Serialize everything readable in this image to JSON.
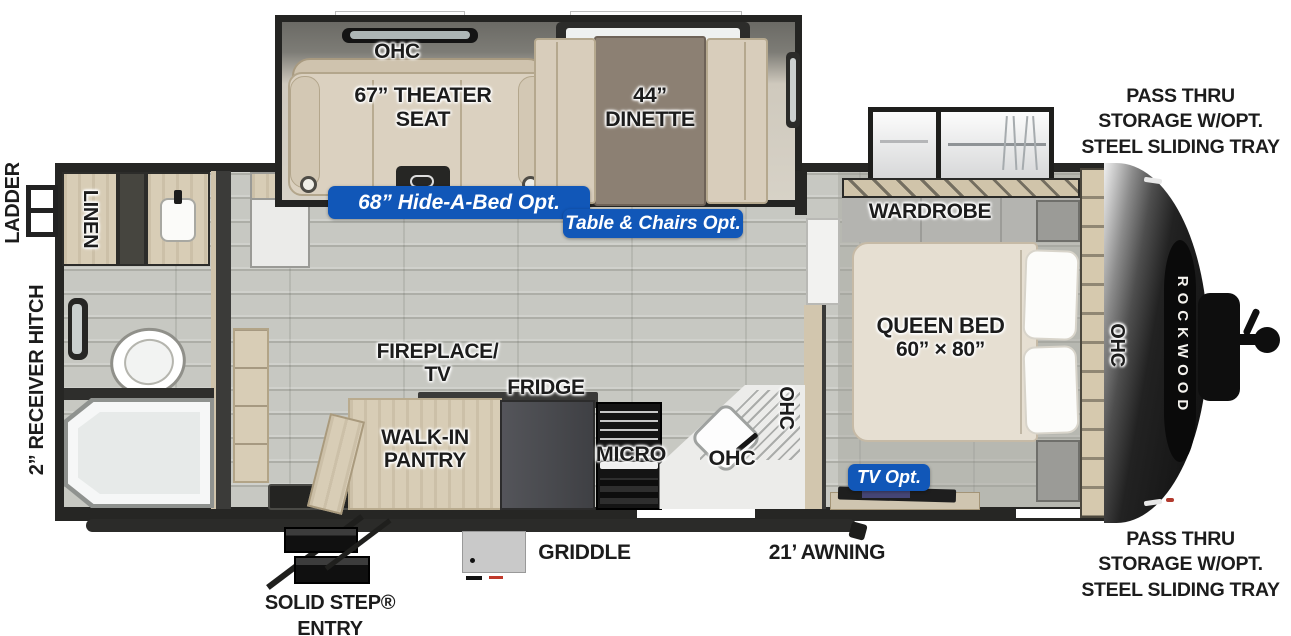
{
  "floorplan": {
    "exterior": {
      "ladder": "LADDER",
      "receiver_hitch": "2” RECEIVER HITCH",
      "pass_thru_storage": [
        "PASS THRU",
        "STORAGE W/OPT.",
        "STEEL SLIDING TRAY"
      ],
      "solid_step_entry": [
        "SOLID STEP®",
        "ENTRY"
      ],
      "griddle": "GRIDDLE",
      "awning": "21’ AWNING"
    },
    "rooms": {
      "ohc_slide": "OHC",
      "theater_seat": [
        "67” THEATER",
        "SEAT"
      ],
      "dinette": [
        "44”",
        "DINETTE"
      ],
      "linen": "LINEN",
      "wardrobe": "WARDROBE",
      "queen_bed": [
        "QUEEN BED",
        "60” × 80”"
      ],
      "ohc_front": "OHC",
      "fireplace_tv": [
        "FIREPLACE/",
        "TV"
      ],
      "fridge": "FRIDGE",
      "walk_in_pantry": [
        "WALK-IN",
        "PANTRY"
      ],
      "micro": "MICRO",
      "ohc_kitchen": "OHC",
      "ohc_sink_wall": "OHC"
    },
    "options": {
      "hide_a_bed": "68” Hide-A-Bed Opt.",
      "table_chairs": "Table & Chairs Opt.",
      "tv": "TV Opt."
    },
    "brand": {
      "front_cap": "ROCKWOOD"
    },
    "colors": {
      "option_tag_blue": "#1157b8",
      "wall": "#262624",
      "floor": "#c7c8c2",
      "cabinet_tan": "#d6cab2"
    }
  }
}
